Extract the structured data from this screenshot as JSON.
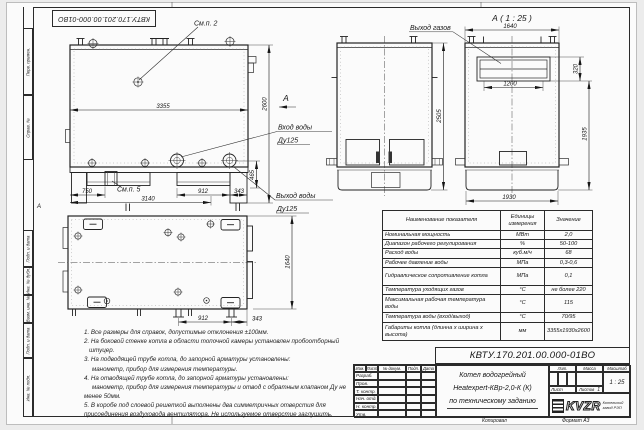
{
  "page": {
    "zone_mark": "А"
  },
  "stamp_top": {
    "number": "КВТУ.170.201.00.000-01ВО"
  },
  "sidebar": {
    "labels": [
      "Перв. примен.",
      "Справ. №",
      "Подп. и дата",
      "Инв. № дубл.",
      "Взам. инв. №",
      "Подп. и дата",
      "Инв. № подл."
    ]
  },
  "side_view": {
    "callout_top": "См.п. 2",
    "callout_bottom": "См.п. 5",
    "dim_length": "3355",
    "dim_height": "2600",
    "dim_nozzle_height": "465",
    "dim_750": "750",
    "dim_3140": "3140",
    "dim_912": "912",
    "dim_343": "343",
    "inlet_line1": "Вход воды",
    "inlet_line2": "Ду125",
    "outlet_line1": "Выход воды",
    "outlet_line2": "Ду125",
    "view_arrow_label": "А"
  },
  "front_view": {
    "dim_height": "2505"
  },
  "view_a": {
    "title": "А ( 1 : 25 )",
    "gas_label": "Выход газов",
    "dim_width_top": "1640",
    "dim_outlet_width": "1200",
    "dim_outlet_height": "320",
    "dim_height": "1935",
    "dim_width_bottom": "1930"
  },
  "plan_view": {
    "dim_width": "1640",
    "dim_912": "912",
    "dim_343": "343"
  },
  "notes": {
    "lines": [
      "1. Все размеры для справок, допустимые отклонения ±100мм.",
      "2. На боковой стенке котла в области топочной камеры установлен пробоотборный",
      "штуцер.",
      "3. На подводящей трубе котла, до запорной арматуры установлены:",
      "манометр, прибор для измерения температуры.",
      "4. На отводящей трубе котла, до запорной арматуры установлены:",
      "манометр, прибор для измерения температуры и отвод с обратным клапаном Ду не",
      "менее 50мм.",
      "5. В коробе под слоевой решеткой выполнены два симметричных отверстия для",
      "присоединения воздуховода вентилятора. Не используемое отверстие заглушить."
    ]
  },
  "table": {
    "headers": [
      "Наименование показателя",
      "Единицы измерения",
      "Значение"
    ],
    "rows": [
      [
        "Номинальная мощность",
        "МВт",
        "2,0"
      ],
      [
        "Диапазон рабочего регулирования",
        "%",
        "50-100"
      ],
      [
        "Расход воды",
        "куб.м/ч",
        "68"
      ],
      [
        "Рабочее давление воды",
        "МПа",
        "0,3-0,6"
      ],
      [
        "Гидравлическое сопротивление котла",
        "МПа",
        "0,1"
      ],
      [
        "Температура уходящих газов",
        "°С",
        "не более 220"
      ],
      [
        "Максимальная рабочая температура воды",
        "°С",
        "115"
      ],
      [
        "Температура воды (вход/выход)",
        "°С",
        "70/95"
      ],
      [
        "Габариты котла (длинна х ширина х высота)",
        "мм",
        "3355х1930х2600"
      ]
    ]
  },
  "title_block": {
    "doc_number": "КВТУ.170.201.00.000-01ВО",
    "product_line1": "Котел водогрейный",
    "product_line2": "Heatexpert-КВр-2,0-К (К)",
    "product_line3": "по техническому заданию",
    "col_izm": "Изм.",
    "col_list": "Лист",
    "col_doc": "№ докум.",
    "col_podp": "Подп.",
    "col_data": "Дата",
    "rows": [
      "Разраб.",
      "Пров.",
      "Т. контр.",
      "Нач. отд.",
      "Н. контр.",
      "Утв."
    ],
    "lit": "Лит.",
    "mass": "Масса",
    "scale_label": "Масштаб",
    "scale": "1 : 25",
    "sheet_label": "Лист",
    "sheets_label": "Листов",
    "sheets": "1",
    "logo": "KVZR",
    "logo_sub1": "Котельный",
    "logo_sub2": "завод РЭП",
    "copied": "Копировал",
    "format": "Формат А3"
  }
}
